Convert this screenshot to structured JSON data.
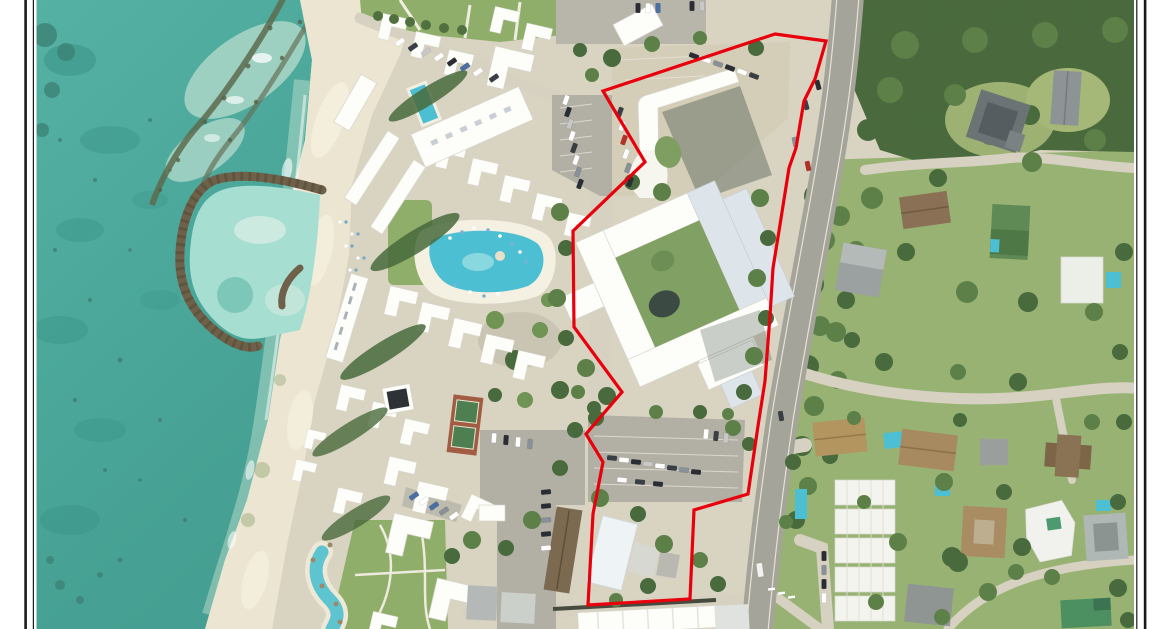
{
  "figure": {
    "type": "aerial-site-map",
    "description": "Aerial photograph of a beachfront resort property; subject parcel outlined in red, bounded by a coastal road on the east with forest and residential parcels beyond, turquoise ocean, breakwaters and sandy beach on the west. Black double-rule page frame on left and right edges. No text is visible in the image.",
    "boundary": {
      "color": "#e8000d",
      "stroke_width": 3.2,
      "points": "775,34 826,41 815,79 804,101 796,148 789,168 779,231 773,268 770,316 765,381 758,426 748,494 694,510 690,599 588,605 593,514 603,462 586,434 622,392 574,327 573,231 645,162 603,91"
    },
    "frame": {
      "color": "#1a1a1a"
    },
    "palette": {
      "ocean": "#4ba89a",
      "shallow": "#cfe4d6",
      "beach": "#ece5d2",
      "grass": "#8fae6a",
      "forest": "#4a6a3e",
      "road": "#a5a49a",
      "building": "#fdfdf9",
      "pool": "#4cc0d2",
      "ground": "#d9d3c1"
    }
  }
}
